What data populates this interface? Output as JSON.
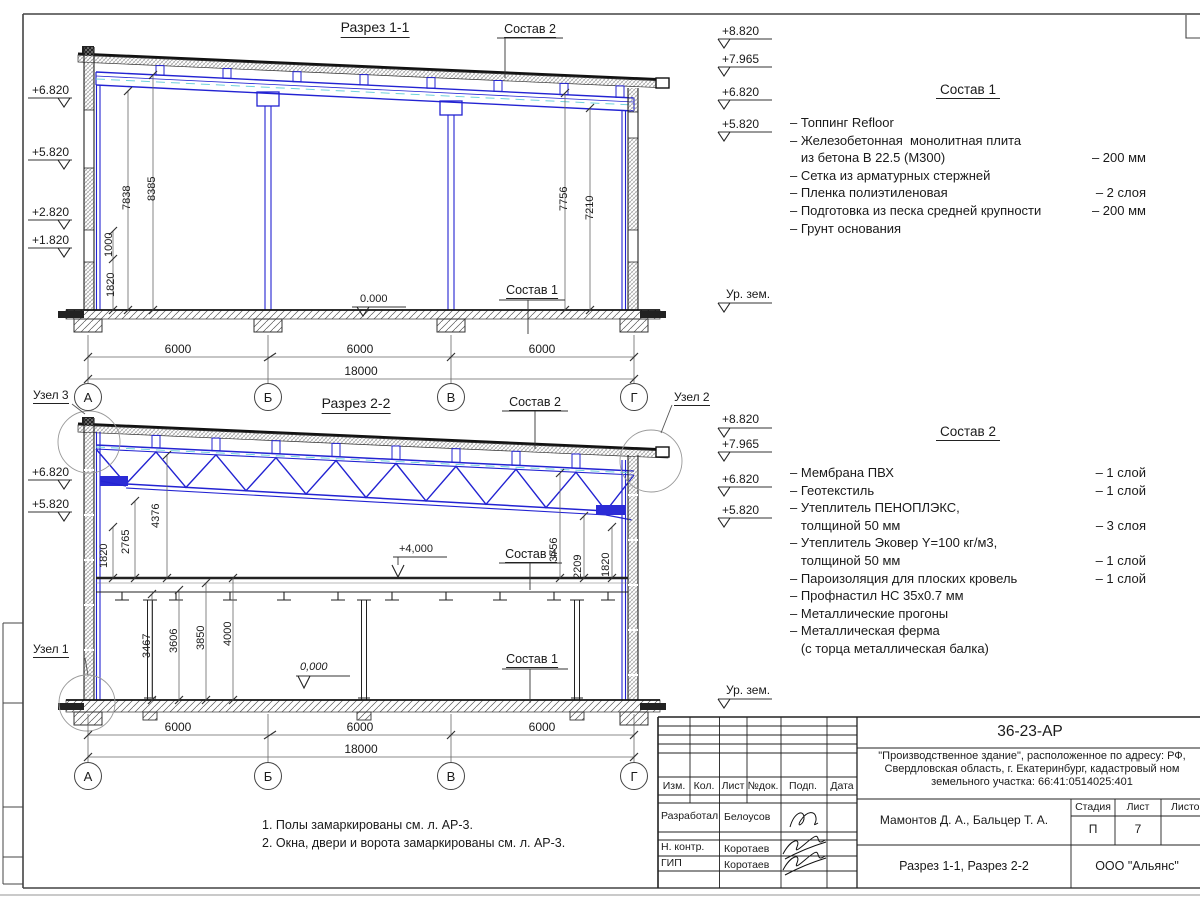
{
  "section1": {
    "title": "Разрез 1-1",
    "label_sostav2": "Состав 2",
    "label_sostav1": "Состав 1",
    "level_zero": "0.000",
    "elev": {
      "e6820": "+6.820",
      "e5820": "+5.820",
      "e2820": "+2.820",
      "e1820": "+1.820",
      "e8820": "+8.820",
      "e7965": "+7.965",
      "r6820": "+6.820",
      "r5820": "+5.820",
      "ground": "Ур. зем."
    },
    "vdim": {
      "d1820": "1820",
      "d1000": "1000",
      "d7838": "7838",
      "d8385": "8385",
      "d7756": "7756",
      "d7210": "7210"
    },
    "hdim": {
      "s1": "6000",
      "s2": "6000",
      "s3": "6000",
      "total": "18000"
    },
    "axes": {
      "a": "А",
      "b": "Б",
      "v": "В",
      "g": "Г"
    }
  },
  "section2": {
    "title": "Разрез 2-2",
    "label_sostav2": "Состав 2",
    "label_sostav4": "Состав 4",
    "label_sostav1": "Состав 1",
    "level_4000": "+4,000",
    "level_zero": "0,000",
    "node1": "Узел 1",
    "node2": "Узел 2",
    "node3": "Узел 3",
    "elev": {
      "e8820": "+8.820",
      "e7965": "+7.965",
      "r6820": "+6.820",
      "r5820": "+5.820",
      "l6820": "+6.820",
      "l5820": "+5.820",
      "ground": "Ур. зем."
    },
    "vdim": {
      "d1820l": "1820",
      "d2765": "2765",
      "d4376": "4376",
      "d3756": "3756",
      "d2209": "2209",
      "d1820r": "1820",
      "d3467": "3467",
      "d3606": "3606",
      "d3850": "3850",
      "d4000": "4000"
    },
    "hdim": {
      "s1": "6000",
      "s2": "6000",
      "s3": "6000",
      "total": "18000"
    },
    "axes": {
      "a": "А",
      "b": "Б",
      "v": "В",
      "g": "Г"
    }
  },
  "spec1": {
    "title": "Состав 1",
    "rows": [
      {
        "t": "– Топпинг Refloor",
        "v": ""
      },
      {
        "t": "– Железобетонная  монолитная плита",
        "v": ""
      },
      {
        "t": "   из бетона В 22.5 (М300)",
        "v": "– 200 мм"
      },
      {
        "t": "– Сетка из арматурных стержней",
        "v": ""
      },
      {
        "t": "– Пленка полиэтиленовая",
        "v": "– 2 слоя"
      },
      {
        "t": "– Подготовка из песка средней крупности",
        "v": "– 200 мм"
      },
      {
        "t": "– Грунт основания",
        "v": ""
      }
    ]
  },
  "spec2": {
    "title": "Состав 2",
    "rows": [
      {
        "t": "– Мембрана ПВХ",
        "v": "– 1 слой"
      },
      {
        "t": "– Геотекстиль",
        "v": "– 1 слой"
      },
      {
        "t": "– Утеплитель ПЕНОПЛЭКС,",
        "v": ""
      },
      {
        "t": "   толщиной 50 мм",
        "v": "– 3 слоя"
      },
      {
        "t": "– Утеплитель Эковер Y=100 кг/м3,",
        "v": ""
      },
      {
        "t": "   толщиной 50 мм",
        "v": "– 1 слой"
      },
      {
        "t": "– Пароизоляция для плоских кровель",
        "v": "– 1 слой"
      },
      {
        "t": "– Профнастил НС 35х0.7 мм",
        "v": ""
      },
      {
        "t": "– Металлические прогоны",
        "v": ""
      },
      {
        "t": "– Металлическая ферма",
        "v": ""
      },
      {
        "t": "   (с торца металлическая балка)",
        "v": ""
      }
    ]
  },
  "notes": {
    "n1": "1. Полы замаркированы см. л. АР-3.",
    "n2": "2. Окна, двери и ворота замаркированы см. л. АР-3."
  },
  "titleblock": {
    "code": "36-23-АР",
    "object_line1": "\"Производственное здание\", расположенное по адресу: РФ,",
    "object_line2": "Свердловская область, г. Екатеринбург, кадастровый ном",
    "object_line3": "земельного участка: 66:41:0514025:401",
    "col_izm": "Изм.",
    "col_kol": "Кол.",
    "col_list": "Лист",
    "col_doc": "№док.",
    "col_podp": "Подп.",
    "col_data": "Дата",
    "role1": "Разработал",
    "name1": "Белоусов",
    "role2": "Н. контр.",
    "name2": "Коротаев",
    "role3": "ГИП",
    "name3": "Коротаев",
    "authors": "Мамонтов Д. А., Бальцер Т. А.",
    "stage_label": "Стадия",
    "sheet_label": "Лист",
    "sheets_label": "Листов",
    "stage": "П",
    "sheet": "7",
    "doc_title": "Разрез 1-1, Разрез 2-2",
    "company": "ООО \"Альянс\""
  }
}
